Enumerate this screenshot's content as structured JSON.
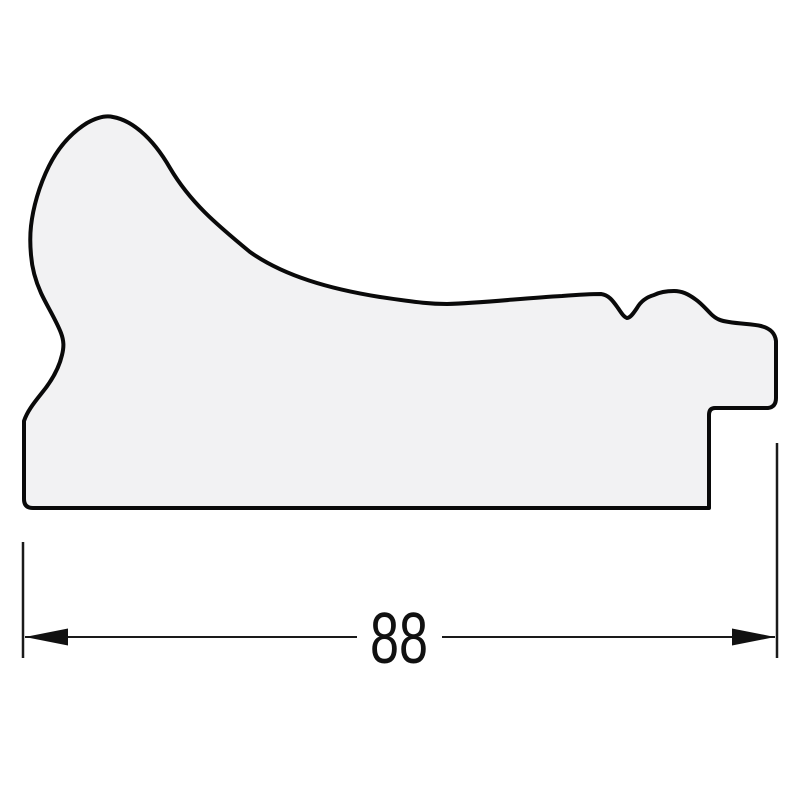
{
  "drawing": {
    "profile_path": "M 113,117 C 130,120 151,135 170,168 C 190,202 216,224 250,252 C 284,276 330,289 380,297 C 420,303 432,304 447,304 C 482,303 525,298 562,296 C 575,295 592,294 601,294 C 609,295 613,301 618,308 C 622,314 624,317 627,318 C 630,318 633,314 637,308 C 641,301 647,297 654,295 C 660,292 667,291 674,291 C 682,291 688,294 695,299 C 701,303 706,309 711,314 C 716,319 721,321 729,322 C 741,324 753,324 761,326 C 769,328 775,332 776,341 L 776,398 Q 776,407 768,408 L 715,408 Q 709,408 709,415 L 709,508 L 33,508 Q 24,508 24,499 L 24,421 C 27,412 33,404 41,394 C 51,382 59,368 62,355 C 64,347 64,341 61,333 C 56,320 47,306 41,293 C 36,282 32,268 31,255 C 30,244 30,235 31,226 C 33,208 39,186 49,166 C 58,148 71,133 87,123 C 96,118 105,115 113,117 Z"
  },
  "dimension": {
    "value": "88"
  },
  "colors": {
    "background": "#ffffff",
    "profile_fill": "#f2f2f3",
    "line": "#0a0a0a"
  }
}
